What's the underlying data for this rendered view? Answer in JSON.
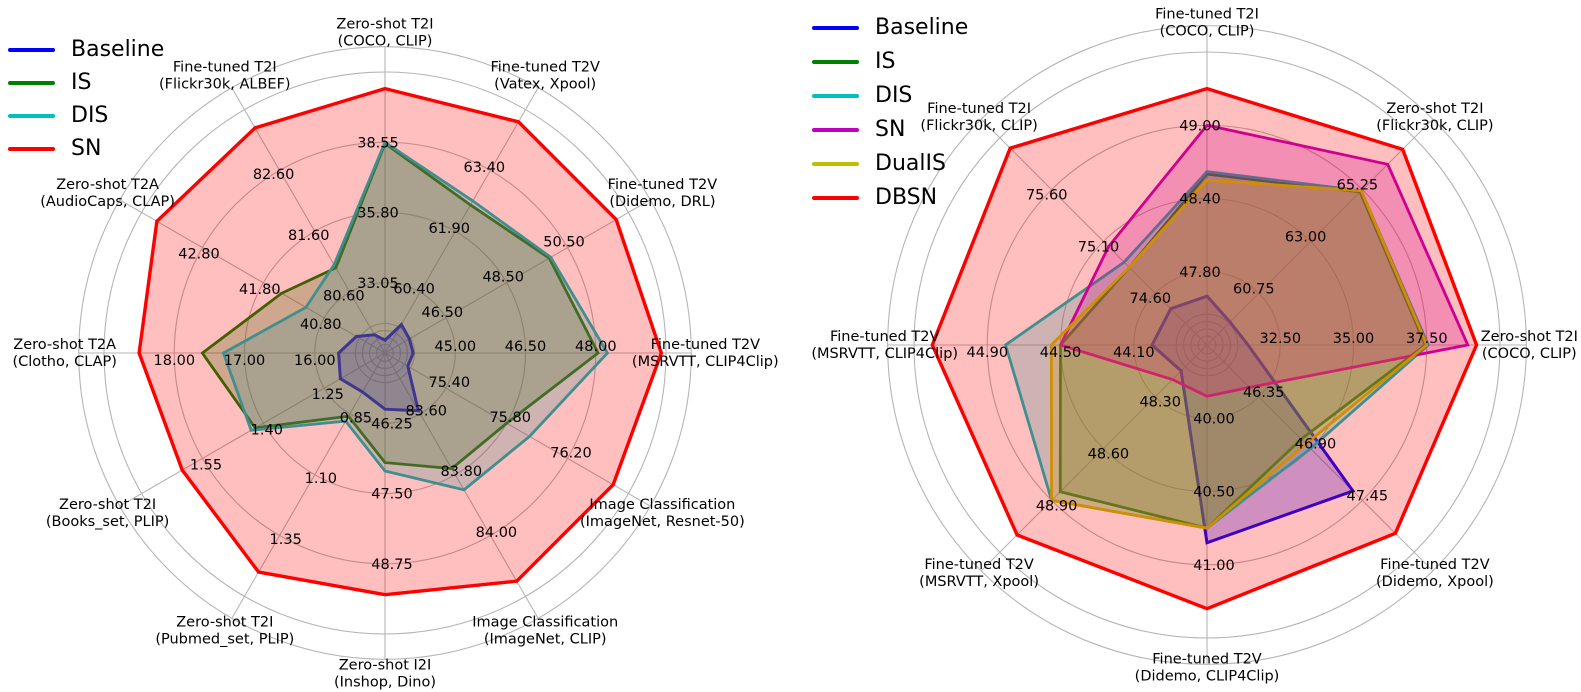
{
  "figure": {
    "background": "#ffffff",
    "grid_color": "#b5b5b5",
    "text_color": "#000000"
  },
  "chart_data": [
    {
      "type": "radar",
      "id": "left",
      "legend_position": "upper left",
      "grid": true,
      "ring_fractions": [
        0.25,
        0.5,
        0.75
      ],
      "legend": [
        {
          "label": "Baseline",
          "color": "#0000ff"
        },
        {
          "label": "IS",
          "color": "#008000"
        },
        {
          "label": "DIS",
          "color": "#00bfbf"
        },
        {
          "label": "SN",
          "color": "#ff0000"
        }
      ],
      "axes": [
        {
          "title": "Zero-shot T2I",
          "subtitle": "(COCO, CLIP)",
          "ticks": [
            33.05,
            35.8,
            38.55
          ]
        },
        {
          "title": "Fine-tuned T2V",
          "subtitle": "(Vatex, Xpool)",
          "ticks": [
            60.4,
            61.9,
            63.4
          ]
        },
        {
          "title": "Fine-tuned T2V",
          "subtitle": "(Didemo, DRL)",
          "ticks": [
            46.5,
            48.5,
            50.5
          ]
        },
        {
          "title": "Fine-tuned T2V",
          "subtitle": "(MSRVTT, CLIP4Clip)",
          "ticks": [
            45.0,
            46.5,
            48.0
          ]
        },
        {
          "title": "Image Classification",
          "subtitle": "(ImageNet, Resnet-50)",
          "ticks": [
            75.4,
            75.8,
            76.2
          ]
        },
        {
          "title": "Image Classification",
          "subtitle": "(ImageNet, CLIP)",
          "ticks": [
            83.6,
            83.8,
            84.0
          ]
        },
        {
          "title": "Zero-shot I2I",
          "subtitle": "(Inshop, Dino)",
          "ticks": [
            46.25,
            47.5,
            48.75
          ]
        },
        {
          "title": "Zero-shot T2I",
          "subtitle": "(Pubmed_set, PLIP)",
          "ticks": [
            0.85,
            1.1,
            1.35
          ]
        },
        {
          "title": "Zero-shot T2I",
          "subtitle": "(Books_set, PLIP)",
          "ticks": [
            1.25,
            1.4,
            1.55
          ]
        },
        {
          "title": "Zero-shot T2A",
          "subtitle": "(Clotho, CLAP)",
          "ticks": [
            16.0,
            17.0,
            18.0
          ]
        },
        {
          "title": "Zero-shot T2A",
          "subtitle": "(AudioCaps, CLAP)",
          "ticks": [
            40.8,
            41.8,
            42.8
          ]
        },
        {
          "title": "Fine-tuned T2I",
          "subtitle": "(Flickr30k, ALBEF)",
          "ticks": [
            80.6,
            81.6,
            82.6
          ]
        }
      ],
      "series": [
        {
          "name": "Baseline",
          "color": "#0000ff",
          "values": [
            30.8,
            59.6,
            45.3,
            44.1,
            75.15,
            83.59,
            46.0,
            0.76,
            1.21,
            15.66,
            40.27,
            79.9
          ]
        },
        {
          "name": "IS",
          "color": "#008000",
          "values": [
            38.5,
            62.55,
            49.9,
            48.05,
            75.8,
            83.78,
            46.95,
            0.86,
            1.42,
            17.6,
            41.5,
            81.0
          ]
        },
        {
          "name": "DIS",
          "color": "#00bfbf",
          "values": [
            38.55,
            62.65,
            49.95,
            48.25,
            75.95,
            83.85,
            47.1,
            0.88,
            1.43,
            17.3,
            41.1,
            81.05
          ]
        },
        {
          "name": "SN",
          "color": "#ff0000",
          "values": [
            40.65,
            64.6,
            52.1,
            49.4,
            76.5,
            84.15,
            49.3,
            1.5,
            1.6,
            18.5,
            43.55,
            83.3
          ]
        }
      ]
    },
    {
      "type": "radar",
      "id": "right",
      "legend_position": "upper left",
      "grid": true,
      "ring_fractions": [
        0.25,
        0.5,
        0.75
      ],
      "legend": [
        {
          "label": "Baseline",
          "color": "#0000ff"
        },
        {
          "label": "IS",
          "color": "#008000"
        },
        {
          "label": "DIS",
          "color": "#00bfbf"
        },
        {
          "label": "SN",
          "color": "#bf00bf"
        },
        {
          "label": "DualIS",
          "color": "#bfbf00"
        },
        {
          "label": "DBSN",
          "color": "#ff0000"
        }
      ],
      "axes": [
        {
          "title": "Fine-tuned T2I",
          "subtitle": "(COCO, CLIP)",
          "ticks": [
            47.8,
            48.4,
            49.0
          ]
        },
        {
          "title": "Zero-shot T2I",
          "subtitle": "(Flickr30k, CLIP)",
          "ticks": [
            60.75,
            63.0,
            65.25
          ]
        },
        {
          "title": "Zero-shot T2I",
          "subtitle": "(COCO, CLIP)",
          "ticks": [
            32.5,
            35.0,
            37.5
          ]
        },
        {
          "title": "Fine-tuned T2V",
          "subtitle": "(Didemo, Xpool)",
          "ticks": [
            46.35,
            46.9,
            47.45
          ]
        },
        {
          "title": "Fine-tuned T2V",
          "subtitle": "(Didemo, CLIP4Clip)",
          "ticks": [
            40.0,
            40.5,
            41.0
          ]
        },
        {
          "title": "Fine-tuned T2V",
          "subtitle": "(MSRVTT, Xpool)",
          "ticks": [
            48.3,
            48.6,
            48.9
          ]
        },
        {
          "title": "Fine-tuned T2V",
          "subtitle": "(MSRVTT, CLIP4Clip)",
          "ticks": [
            44.1,
            44.5,
            44.9
          ]
        },
        {
          "title": "Fine-tuned T2I",
          "subtitle": "(Flickr30k, CLIP)",
          "ticks": [
            74.6,
            75.1,
            75.6
          ]
        }
      ],
      "series": [
        {
          "name": "Baseline",
          "color": "#0000ff",
          "values": [
            47.6,
            59.5,
            31.4,
            47.35,
            40.85,
            48.15,
            44.0,
            74.45
          ]
        },
        {
          "name": "IS",
          "color": "#008000",
          "values": [
            48.6,
            65.15,
            37.45,
            46.8,
            40.75,
            48.85,
            44.5,
            74.85
          ]
        },
        {
          "name": "DIS",
          "color": "#00bfbf",
          "values": [
            48.62,
            65.2,
            37.55,
            46.9,
            40.75,
            48.9,
            44.8,
            74.9
          ]
        },
        {
          "name": "SN",
          "color": "#bf00bf",
          "values": [
            49.0,
            66.35,
            38.9,
            46.25,
            39.85,
            48.2,
            44.5,
            75.05
          ]
        },
        {
          "name": "DualIS",
          "color": "#bfbf00",
          "values": [
            48.55,
            65.2,
            37.5,
            46.85,
            40.75,
            48.9,
            44.55,
            74.85
          ]
        },
        {
          "name": "DBSN",
          "color": "#ff0000",
          "values": [
            49.3,
            67.0,
            39.2,
            47.8,
            41.3,
            49.1,
            45.2,
            76.0
          ]
        }
      ]
    }
  ]
}
